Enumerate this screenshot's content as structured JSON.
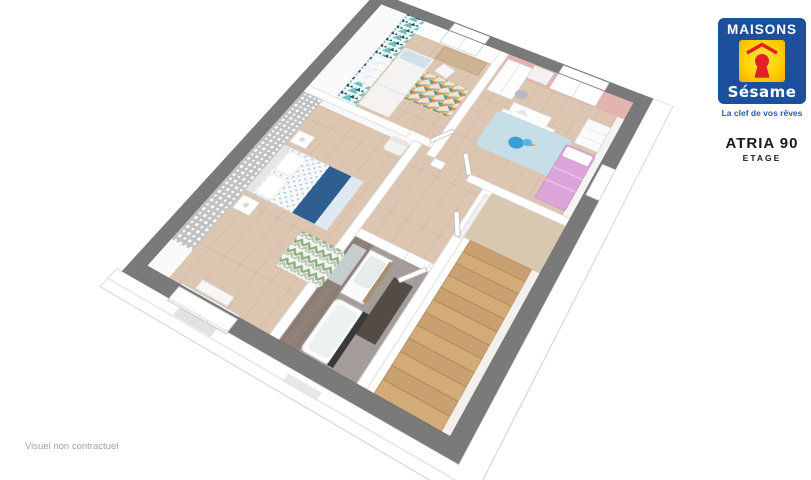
{
  "brand": {
    "name_top": "MAISONS",
    "name_bottom": "Sésame",
    "tagline": "La clef de vos rêves"
  },
  "plan": {
    "title": "ATRIA 90",
    "subtitle": "ETAGE",
    "footnote": "Visuel non contractuel"
  },
  "floorplan": {
    "view": "3d-axonometric-floor-cutaway",
    "rooms": [
      {
        "id": "bedroom-1",
        "accent": "teal-triangle-wallpaper"
      },
      {
        "id": "bedroom-2-kids",
        "accent": "pink-wall"
      },
      {
        "id": "master-bedroom",
        "accent": "gray-damask-wallpaper"
      },
      {
        "id": "bathroom",
        "accent": "taupe-wood-wall"
      },
      {
        "id": "landing-hallway",
        "accent": "white-walls"
      },
      {
        "id": "staircase",
        "accent": "wood-steps"
      }
    ]
  },
  "colors": {
    "brand_blue": "#1c4f9c",
    "brand_yellow": "#ffd200",
    "brand_red": "#e02127",
    "tagline_blue": "#2a5aa5",
    "title_black": "#1a1a1a",
    "footnote_gray": "#a0a0a0",
    "wall_gray": "#7a7a7a",
    "floor_wood": "#dcc6b2",
    "floor_wood_line": "#ccb29a",
    "stair_wood": "#c9a170",
    "stair_wood_dark": "#ab8253",
    "bath_floor": "#a49d9a",
    "bath_wall": "#8e8076",
    "teal": "#6fc0bf",
    "teal_dark": "#30485c",
    "pink_wall": "#e3b3ae",
    "pink_bed": "#dca4da",
    "damask_gray": "#c2c2c2",
    "rug_blue": "#c5dee8",
    "rug_green": "#8fae83",
    "navy": "#2e5f8e",
    "duvet_blue": "#a6c4e0",
    "desk_wood": "#cdb391",
    "mat_dark": "#4a433d",
    "eave_line": "#d8d8d8"
  }
}
